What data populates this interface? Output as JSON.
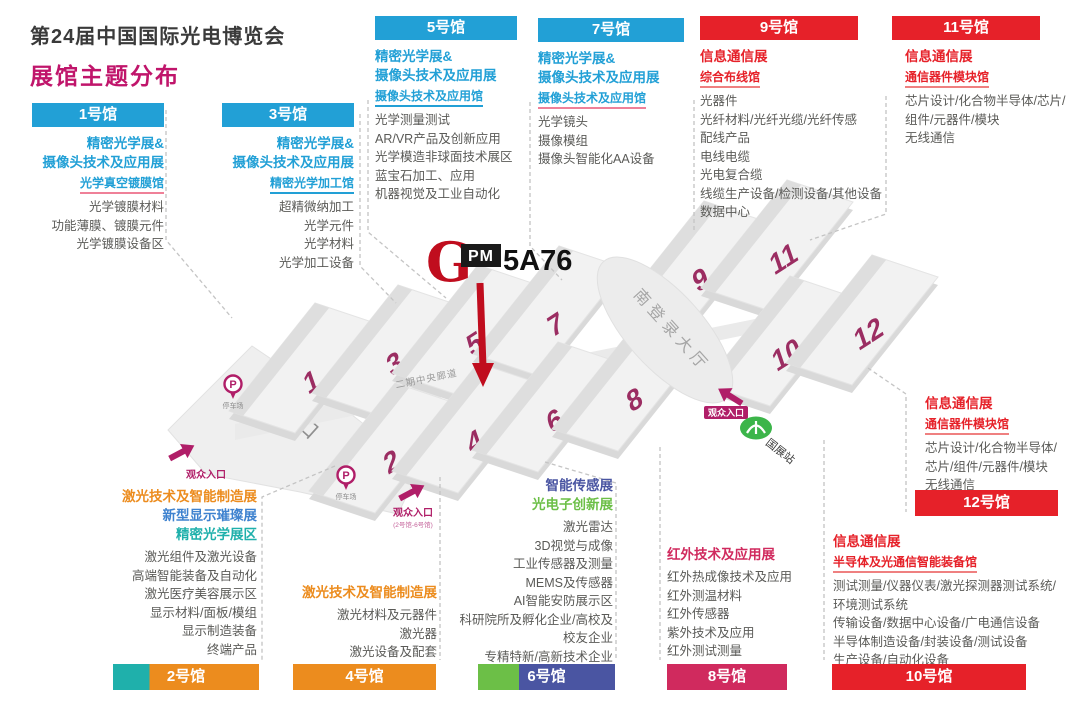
{
  "page": {
    "title": "第24届中国国际光电博览会",
    "subtitle": "展馆主题分布"
  },
  "logo": {
    "g": "G",
    "pm": "PM",
    "code": "5A76"
  },
  "map": {
    "halls": [
      "1",
      "3",
      "5",
      "7",
      "9",
      "11",
      "2",
      "4",
      "6",
      "8",
      "10",
      "12"
    ],
    "south_entrance": "南入口",
    "south_hall": "南登录大厅",
    "corridor": "二期中央廊道",
    "visitor_entrance": "观众入口",
    "visitor_entrance_sub": "(2号馆-6号馆)",
    "parking": "停车场",
    "metro_station": "国展站"
  },
  "halls": {
    "h1": {
      "header": "1号馆",
      "title_lines": [
        "精密光学展&",
        "摄像头技术及应用展"
      ],
      "subtitle": "光学真空镀膜馆",
      "items": [
        "光学镀膜材料",
        "功能薄膜、镀膜元件",
        "光学镀膜设备区"
      ]
    },
    "h3": {
      "header": "3号馆",
      "title_lines": [
        "精密光学展&",
        "摄像头技术及应用展"
      ],
      "subtitle": "精密光学加工馆",
      "items": [
        "超精微纳加工",
        "光学元件",
        "光学材料",
        "光学加工设备"
      ]
    },
    "h5": {
      "header": "5号馆",
      "title_lines": [
        "精密光学展&",
        "摄像头技术及应用展"
      ],
      "subtitle": "摄像头技术及应用馆",
      "items": [
        "光学测量测试",
        "AR/VR产品及创新应用",
        "光学模造非球面技术展区",
        "蓝宝石加工、应用",
        "机器视觉及工业自动化"
      ]
    },
    "h7": {
      "header": "7号馆",
      "title_lines": [
        "精密光学展&",
        "摄像头技术及应用展"
      ],
      "subtitle": "摄像头技术及应用馆",
      "items": [
        "光学镜头",
        "摄像模组",
        "摄像头智能化AA设备"
      ]
    },
    "h9": {
      "header": "9号馆",
      "title": "信息通信展",
      "subtitle": "综合布线馆",
      "items": [
        "光器件",
        "光纤材料/光纤光缆/光纤传感",
        "配线产品",
        "电线电缆",
        "光电复合缆",
        "线缆生产设备/检测设备/其他设备",
        "数据中心"
      ]
    },
    "h11": {
      "header": "11号馆",
      "title": "信息通信展",
      "subtitle": "通信器件模块馆",
      "items": [
        "芯片设计/化合物半导体/芯片/组件/元器件/模块",
        "无线通信"
      ]
    },
    "h2": {
      "footer": "2号馆",
      "titles": [
        {
          "text": "激光技术及智能制造展",
          "color": "#ec8c1e"
        },
        {
          "text": "新型显示璀璨展",
          "color": "#3e82cf"
        },
        {
          "text": "精密光学展区",
          "color": "#1fb0ab"
        }
      ],
      "items": [
        "激光组件及激光设备",
        "高端智能装备及自动化",
        "激光医疗美容展示区",
        "显示材料/面板/模组",
        "显示制造装备",
        "终端产品"
      ]
    },
    "h4": {
      "footer": "4号馆",
      "title": "激光技术及智能制造展",
      "items": [
        "激光材料及元器件",
        "激光器",
        "激光设备及配套"
      ]
    },
    "h6": {
      "footer": "6号馆",
      "titles": [
        {
          "text": "智能传感展",
          "color": "#4a55a2"
        },
        {
          "text": "光电子创新展",
          "color": "#6cbf47"
        }
      ],
      "items": [
        "激光雷达",
        "3D视觉与成像",
        "工业传感器及测量",
        "MEMS及传感器",
        "AI智能安防展示区",
        "科研院所及孵化企业/高校及",
        "校友企业",
        "专精特新/高新技术企业"
      ]
    },
    "h8": {
      "footer": "8号馆",
      "title": "红外技术及应用展",
      "items": [
        "红外热成像技术及应用",
        "红外测温材料",
        "红外传感器",
        "紫外技术及应用",
        "红外测试测量"
      ]
    },
    "h10": {
      "footer": "10号馆",
      "title": "信息通信展",
      "subtitle": "半导体及光通信智能装备馆",
      "items": [
        "测试测量/仪器仪表/激光探测器测试系统/环境测试系统",
        "传输设备/数据中心设备/广电通信设备",
        "半导体制造设备/封装设备/测试设备",
        "生产设备/自动化设备"
      ]
    },
    "h12": {
      "footer": "12号馆",
      "title": "信息通信展",
      "subtitle": "通信器件模块馆",
      "items": [
        "芯片设计/化合物半导体/芯片/组件/元器件/模块",
        "无线通信"
      ]
    }
  },
  "colors": {
    "blue": "#22a0d6",
    "red": "#e62129",
    "magenta": "#c0156b",
    "orange": "#ec8c1e",
    "teal": "#1fb0ab",
    "indigo": "#4a55a2",
    "green": "#6cbf47",
    "crimson": "#d02a5e",
    "map_number": "#9b2d62",
    "entrance": "#b01e68",
    "metro_green": "#3cb54a"
  }
}
